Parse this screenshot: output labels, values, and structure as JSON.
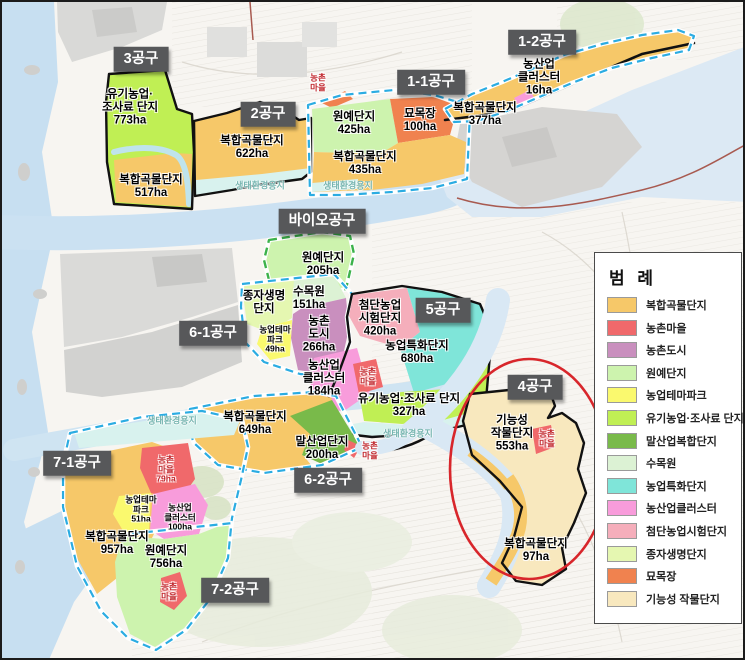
{
  "legend": {
    "title": "범 례",
    "items": [
      {
        "label": "복합곡물단지",
        "color": "#F6C869"
      },
      {
        "label": "농촌마을",
        "color": "#F0696B"
      },
      {
        "label": "농촌도시",
        "color": "#C98FBE"
      },
      {
        "label": "원예단지",
        "color": "#CDF3AE"
      },
      {
        "label": "농업테마파크",
        "color": "#FAF96E"
      },
      {
        "label": "유기농업·조사료 단지",
        "color": "#C0EF54"
      },
      {
        "label": "말산업복합단지",
        "color": "#79BA4A"
      },
      {
        "label": "수목원",
        "color": "#DCF2D4"
      },
      {
        "label": "농업특화단지",
        "color": "#7FE5D9"
      },
      {
        "label": "농산업클러스터",
        "color": "#F89CDB"
      },
      {
        "label": "첨단농업시험단지",
        "color": "#F5AEBB"
      },
      {
        "label": "종자생명단지",
        "color": "#E5F7B1"
      },
      {
        "label": "묘목장",
        "color": "#F0824F"
      },
      {
        "label": "기능성 작물단지",
        "color": "#F8E8BE"
      }
    ]
  },
  "districts": [
    {
      "label": "3공구",
      "x": 139,
      "y": 57
    },
    {
      "label": "2공구",
      "x": 266,
      "y": 112
    },
    {
      "label": "1-1공구",
      "x": 429,
      "y": 80
    },
    {
      "label": "1-2공구",
      "x": 540,
      "y": 40
    },
    {
      "label": "바이오공구",
      "x": 320,
      "y": 219
    },
    {
      "label": "6-1공구",
      "x": 211,
      "y": 331
    },
    {
      "label": "5공구",
      "x": 441,
      "y": 308
    },
    {
      "label": "4공구",
      "x": 533,
      "y": 385
    },
    {
      "label": "7-1공구",
      "x": 75,
      "y": 461
    },
    {
      "label": "6-2공구",
      "x": 326,
      "y": 478
    },
    {
      "label": "7-2공구",
      "x": 233,
      "y": 588
    }
  ],
  "zones": [
    {
      "lines": [
        "유기농업·",
        "조사료 단지"
      ],
      "area": "773ha",
      "x": 128,
      "y": 106
    },
    {
      "lines": [
        "복합곡물단지"
      ],
      "area": "517ha",
      "x": 149,
      "y": 185
    },
    {
      "lines": [
        "복합곡물단지"
      ],
      "area": "622ha",
      "x": 250,
      "y": 146
    },
    {
      "lines": [
        "원예단지"
      ],
      "area": "425ha",
      "x": 352,
      "y": 122
    },
    {
      "lines": [
        "묘목장"
      ],
      "area": "100ha",
      "x": 418,
      "y": 119
    },
    {
      "lines": [
        "복합곡물단지"
      ],
      "area": "435ha",
      "x": 363,
      "y": 162
    },
    {
      "lines": [
        "농산업",
        "클러스터"
      ],
      "area": "16ha",
      "x": 537,
      "y": 76
    },
    {
      "lines": [
        "복합곡물단지"
      ],
      "area": "377ha",
      "x": 483,
      "y": 113
    },
    {
      "lines": [
        "원예단지"
      ],
      "area": "205ha",
      "x": 321,
      "y": 263
    },
    {
      "lines": [
        "종자생명",
        "단지"
      ],
      "x": 262,
      "y": 301
    },
    {
      "lines": [
        "수목원"
      ],
      "area": "151ha",
      "x": 307,
      "y": 297
    },
    {
      "lines": [
        "농업테마",
        "파크"
      ],
      "area": "49ha",
      "x": 273,
      "y": 338,
      "small": true
    },
    {
      "lines": [
        "농촌",
        "도시"
      ],
      "area": "266ha",
      "x": 317,
      "y": 333
    },
    {
      "lines": [
        "첨단농업",
        "시험단지"
      ],
      "area": "420ha",
      "x": 378,
      "y": 317
    },
    {
      "lines": [
        "농업특화단지"
      ],
      "area": "680ha",
      "x": 415,
      "y": 351
    },
    {
      "lines": [
        "농산업",
        "클러스터"
      ],
      "area": "184ha",
      "x": 322,
      "y": 377
    },
    {
      "lines": [
        "농촌",
        "마을"
      ],
      "x": 366,
      "y": 375,
      "red": true,
      "small": true
    },
    {
      "lines": [
        "유기농업·조사료 단지"
      ],
      "area": "327ha",
      "x": 407,
      "y": 404
    },
    {
      "lines": [
        "복합곡물단지"
      ],
      "area": "649ha",
      "x": 253,
      "y": 422
    },
    {
      "lines": [
        "말산업단지"
      ],
      "area": "200ha",
      "x": 320,
      "y": 447
    },
    {
      "lines": [
        "농촌",
        "마을"
      ],
      "x": 368,
      "y": 449,
      "red": true,
      "small": true
    },
    {
      "lines": [
        "농촌",
        "마을"
      ],
      "x": 316,
      "y": 81,
      "red": true,
      "small": true
    },
    {
      "lines": [
        "농촌",
        "마을"
      ],
      "area": "79ha",
      "x": 164,
      "y": 468,
      "red": true,
      "small": true
    },
    {
      "lines": [
        "농업테마",
        "파크"
      ],
      "area": "51ha",
      "x": 139,
      "y": 508,
      "small": true
    },
    {
      "lines": [
        "농산업",
        "클러스터"
      ],
      "area": "100ha",
      "x": 178,
      "y": 516,
      "small": true
    },
    {
      "lines": [
        "복합곡물단지"
      ],
      "area": "957ha",
      "x": 115,
      "y": 542
    },
    {
      "lines": [
        "원예단지"
      ],
      "area": "756ha",
      "x": 164,
      "y": 556
    },
    {
      "lines": [
        "농촌",
        "마을"
      ],
      "x": 167,
      "y": 590,
      "red": true,
      "small": true
    },
    {
      "lines": [
        "기능성",
        "작물단지"
      ],
      "area": "553ha",
      "x": 510,
      "y": 432
    },
    {
      "lines": [
        "농촌",
        "마을"
      ],
      "x": 545,
      "y": 437,
      "red": true,
      "small": true
    },
    {
      "lines": [
        "복합곡물단지"
      ],
      "area": "97ha",
      "x": 534,
      "y": 549
    }
  ],
  "eco_labels": [
    {
      "text": "생태환경용지",
      "x": 258,
      "y": 183
    },
    {
      "text": "생태환경용지",
      "x": 346,
      "y": 183
    },
    {
      "text": "생태환경용지",
      "x": 406,
      "y": 431
    },
    {
      "text": "생태환경용지",
      "x": 170,
      "y": 418
    }
  ]
}
